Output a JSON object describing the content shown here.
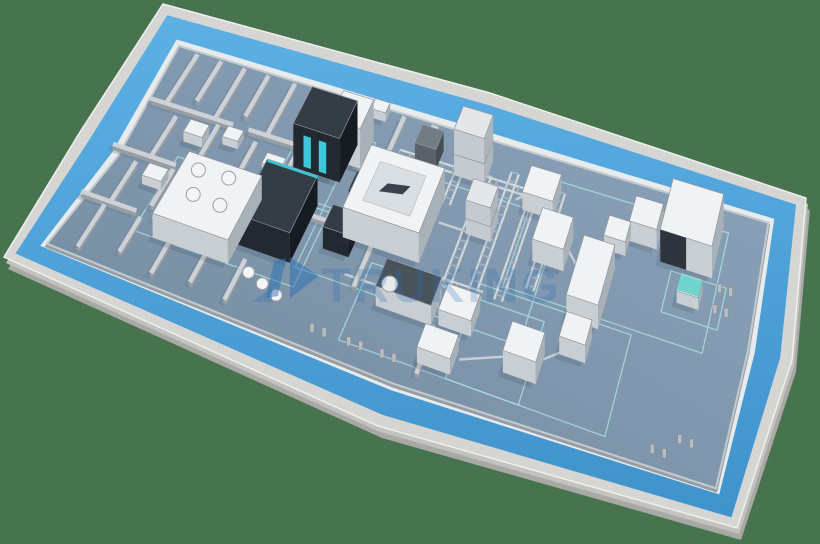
{
  "scene": {
    "canvas": {
      "w": 820,
      "h": 544
    },
    "palette": {
      "bg": "#48734f",
      "slab_side": "#a8a8a5",
      "slab_mid": "#c2c2bf",
      "rim": "#d5d5d3",
      "rim_edge": "#efefed",
      "walkway_light": "#5cb0e4",
      "walkway_dark": "#3f93cb",
      "wall_band": "#e8ebec",
      "inner_wall_edge": "#c3cacd",
      "floor_dark": "#72889c",
      "floor_light": "#8da5bd",
      "wall_top": "#cdd1d5",
      "wall_side": "#969da4",
      "wall_shadow": "#64798d",
      "marking": "#a9dcdd",
      "conv_rail": "#d2d8dc",
      "conv_rung": "#aeb6bd",
      "connector": "#c6ccd2",
      "mach_white_top": "#f0f2f3",
      "mach_white_l": "#c9ced3",
      "mach_white_r": "#a9b1b8",
      "mach_stroke": "#8f969c",
      "mach_dark_top": "#343c46",
      "mach_dark_l": "#232931",
      "mach_dark_r": "#171c22",
      "mach_gray_top": "#737b84",
      "mach_gray_l": "#5a6169",
      "mach_gray_r": "#474d54",
      "cyan": "#3fd9ec",
      "teal": "#5fd0c8",
      "htank_top": "#4a525a",
      "shadow": "#2c3e52",
      "tank_fill": "#f4f5f6",
      "tank_stroke": "#9aa1a8",
      "frame_post": "#b9bec2"
    },
    "outline": [
      [
        163,
        4
      ],
      [
        490,
        93
      ],
      [
        806,
        198
      ],
      [
        792,
        360
      ],
      [
        737,
        528
      ],
      [
        378,
        426
      ],
      [
        4,
        257
      ],
      [
        80,
        132
      ]
    ],
    "bands": {
      "rim": 12,
      "walkway": 26,
      "wall": 7
    },
    "watermark": {
      "text": "TRUKING",
      "color": "#2a6fb6",
      "text_opacity": 0.24,
      "logo_opacity": 0.5,
      "x": 322,
      "y": 302,
      "size": 48,
      "spacing": 3,
      "logo_paths": [
        {
          "d": "M266,298 L274,261 L286,258 L278,296 Z",
          "opacity": 0.5
        },
        {
          "d": "M290,257 L319,276 L290,298 Z",
          "opacity": 0.5
        },
        {
          "d": "M251,302 L272,288 L272,302 Z",
          "opacity": 0.3
        }
      ]
    },
    "walls": [
      [
        0.035,
        0.015,
        0.035,
        0.26
      ],
      [
        0.075,
        0.015,
        0.075,
        0.21
      ],
      [
        0.115,
        0.015,
        0.115,
        0.26
      ],
      [
        0.155,
        0.015,
        0.155,
        0.21
      ],
      [
        0.2,
        0.015,
        0.2,
        0.26
      ],
      [
        0.245,
        0.015,
        0.245,
        0.21
      ],
      [
        0.29,
        0.015,
        0.29,
        0.26
      ],
      [
        0.335,
        0.015,
        0.335,
        0.21
      ],
      [
        0.385,
        0.015,
        0.385,
        0.26
      ],
      [
        0.435,
        0.015,
        0.435,
        0.26
      ],
      [
        0.01,
        0.26,
        0.145,
        0.26
      ],
      [
        0.17,
        0.26,
        0.315,
        0.26
      ],
      [
        0.34,
        0.26,
        0.455,
        0.26
      ],
      [
        0.06,
        0.3,
        0.06,
        0.5
      ],
      [
        0.125,
        0.28,
        0.125,
        0.44
      ],
      [
        0.19,
        0.3,
        0.19,
        0.5
      ],
      [
        0.255,
        0.28,
        0.255,
        0.46
      ],
      [
        0.0,
        0.5,
        0.1,
        0.5
      ],
      [
        0.125,
        0.5,
        0.255,
        0.5
      ],
      [
        0.285,
        0.52,
        0.405,
        0.52
      ],
      [
        0.44,
        0.015,
        0.44,
        0.3
      ],
      [
        0.415,
        0.3,
        0.415,
        0.52
      ],
      [
        0.045,
        0.54,
        0.045,
        0.74
      ],
      [
        0.1,
        0.52,
        0.1,
        0.7
      ],
      [
        0.155,
        0.54,
        0.155,
        0.74
      ],
      [
        0.0,
        0.74,
        0.085,
        0.74
      ],
      [
        0.11,
        0.74,
        0.21,
        0.74
      ],
      [
        0.04,
        0.76,
        0.04,
        0.97
      ],
      [
        0.095,
        0.76,
        0.095,
        0.93
      ],
      [
        0.15,
        0.76,
        0.15,
        0.97
      ],
      [
        0.205,
        0.76,
        0.205,
        0.95
      ],
      [
        0.26,
        0.78,
        0.26,
        0.97
      ],
      [
        0.42,
        0.56,
        0.42,
        0.74
      ],
      [
        0.55,
        0.78,
        0.55,
        0.985
      ]
    ],
    "markings": [
      [
        0.245,
        0.15,
        0.115,
        0.33
      ],
      [
        0.095,
        0.46,
        0.245,
        0.36
      ],
      [
        0.33,
        0.22,
        0.345,
        0.52
      ],
      [
        0.43,
        0.62,
        0.27,
        0.34
      ],
      [
        0.625,
        0.08,
        0.315,
        0.46
      ],
      [
        0.59,
        0.56,
        0.24,
        0.4
      ],
      [
        0.865,
        0.28,
        0.09,
        0.16
      ]
    ],
    "ladders": [
      [
        0.545,
        0.14,
        0.545,
        0.6
      ],
      [
        0.585,
        0.1,
        0.585,
        0.58
      ],
      [
        0.625,
        0.16,
        0.625,
        0.6
      ],
      [
        0.665,
        0.12,
        0.665,
        0.52
      ],
      [
        0.5,
        0.03,
        0.5,
        0.3
      ]
    ],
    "long_rails": [
      [
        0.4,
        0.16,
        0.625,
        0.16
      ],
      [
        0.47,
        0.6,
        0.6,
        0.6
      ]
    ],
    "connectors": [
      [
        0.5,
        0.38,
        0.545,
        0.38
      ],
      [
        0.6,
        0.2,
        0.615,
        0.16
      ],
      [
        0.7,
        0.32,
        0.725,
        0.38
      ],
      [
        0.755,
        0.44,
        0.75,
        0.62
      ],
      [
        0.75,
        0.68,
        0.715,
        0.76
      ],
      [
        0.66,
        0.8,
        0.6,
        0.87
      ],
      [
        0.545,
        0.7,
        0.555,
        0.7
      ],
      [
        0.4,
        0.7,
        0.46,
        0.7
      ],
      [
        0.8,
        0.17,
        0.845,
        0.13
      ],
      [
        0.755,
        0.24,
        0.79,
        0.18
      ]
    ],
    "machines": [
      {
        "name": "tank-farm-unit",
        "u": 0.125,
        "v": 0.52,
        "du": 0.115,
        "dv": 0.3,
        "h": 24,
        "type": "tankfarm"
      },
      {
        "name": "dark-process-machine",
        "u": 0.24,
        "v": 0.47,
        "du": 0.08,
        "dv": 0.26,
        "h": 30,
        "type": "dark",
        "cyantop": true
      },
      {
        "name": "dark-tower-machine",
        "u": 0.26,
        "v": 0.18,
        "du": 0.075,
        "dv": 0.17,
        "h": 44,
        "type": "dark",
        "screens": true
      },
      {
        "name": "white-tower-machine",
        "u": 0.305,
        "v": 0.14,
        "du": 0.05,
        "dv": 0.13,
        "h": 40,
        "type": "white"
      },
      {
        "name": "filling-isolator",
        "u": 0.375,
        "v": 0.28,
        "du": 0.12,
        "dv": 0.28,
        "h": 30,
        "type": "white",
        "big": true
      },
      {
        "name": "gantry-tower",
        "u": 0.495,
        "v": 0.08,
        "du": 0.05,
        "dv": 0.1,
        "h": 46,
        "type": "truss"
      },
      {
        "name": "gantry-frame",
        "u": 0.545,
        "v": 0.3,
        "du": 0.04,
        "dv": 0.09,
        "h": 34,
        "type": "truss"
      },
      {
        "name": "gray-cube-unit",
        "u": 0.43,
        "v": 0.1,
        "du": 0.035,
        "dv": 0.08,
        "h": 20,
        "type": "gray"
      },
      {
        "name": "dark-cube-a",
        "u": 0.355,
        "v": 0.53,
        "du": 0.04,
        "dv": 0.1,
        "h": 22,
        "type": "dark"
      },
      {
        "name": "dark-cube-b",
        "u": 0.365,
        "v": 0.36,
        "du": 0.033,
        "dv": 0.08,
        "h": 20,
        "type": "dark"
      },
      {
        "name": "conveyor-station",
        "u": 0.615,
        "v": 0.12,
        "du": 0.05,
        "dv": 0.11,
        "h": 18,
        "type": "white"
      },
      {
        "name": "inspection-machine",
        "u": 0.655,
        "v": 0.28,
        "du": 0.05,
        "dv": 0.13,
        "h": 22,
        "type": "white"
      },
      {
        "name": "labelling-machine",
        "u": 0.73,
        "v": 0.34,
        "du": 0.05,
        "dv": 0.24,
        "h": 24,
        "type": "white"
      },
      {
        "name": "transfer-unit",
        "u": 0.735,
        "v": 0.62,
        "du": 0.04,
        "dv": 0.1,
        "h": 18,
        "type": "white"
      },
      {
        "name": "case-packer",
        "u": 0.665,
        "v": 0.74,
        "du": 0.05,
        "dv": 0.12,
        "h": 22,
        "type": "white"
      },
      {
        "name": "cartoning-machine",
        "u": 0.845,
        "v": 0.06,
        "du": 0.085,
        "dv": 0.2,
        "h": 32,
        "type": "white",
        "darkpanel": true
      },
      {
        "name": "buffer-station-a",
        "u": 0.79,
        "v": 0.12,
        "du": 0.045,
        "dv": 0.1,
        "h": 20,
        "type": "white"
      },
      {
        "name": "buffer-station-b",
        "u": 0.755,
        "v": 0.2,
        "du": 0.035,
        "dv": 0.08,
        "h": 14,
        "type": "white"
      },
      {
        "name": "agv-robot",
        "u": 0.885,
        "v": 0.32,
        "du": 0.035,
        "dv": 0.07,
        "h": 12,
        "type": "teal"
      },
      {
        "name": "sterilizer-tank",
        "u": 0.46,
        "v": 0.66,
        "du": 0.085,
        "dv": 0.12,
        "h": 20,
        "type": "htank"
      },
      {
        "name": "washing-machine",
        "u": 0.555,
        "v": 0.66,
        "du": 0.05,
        "dv": 0.11,
        "h": 16,
        "type": "white"
      },
      {
        "name": "bottom-line-unit",
        "u": 0.545,
        "v": 0.84,
        "du": 0.05,
        "dv": 0.1,
        "h": 16,
        "type": "white"
      },
      {
        "name": "room-cart-a",
        "u": 0.09,
        "v": 0.33,
        "du": 0.03,
        "dv": 0.06,
        "h": 10,
        "type": "white"
      },
      {
        "name": "room-cart-b",
        "u": 0.145,
        "v": 0.3,
        "du": 0.025,
        "dv": 0.05,
        "h": 8,
        "type": "white"
      },
      {
        "name": "room-cart-c",
        "u": 0.22,
        "v": 0.36,
        "du": 0.03,
        "dv": 0.05,
        "h": 9,
        "type": "white"
      },
      {
        "name": "room-cart-d",
        "u": 0.07,
        "v": 0.56,
        "du": 0.03,
        "dv": 0.06,
        "h": 9,
        "type": "white"
      },
      {
        "name": "room-cart-e",
        "u": 0.3,
        "v": 0.3,
        "du": 0.025,
        "dv": 0.05,
        "h": 8,
        "type": "white"
      },
      {
        "name": "top-wall-door",
        "u": 0.335,
        "v": 0.01,
        "du": 0.025,
        "dv": 0.045,
        "h": 9,
        "type": "white"
      }
    ],
    "tanks": [
      [
        0.275,
        0.84
      ],
      [
        0.3,
        0.865
      ],
      [
        0.325,
        0.89
      ]
    ],
    "door_frames": [
      [
        0.4,
        0.965
      ],
      [
        0.455,
        0.965
      ],
      [
        0.505,
        0.965
      ],
      [
        0.91,
        0.955
      ],
      [
        0.945,
        0.885
      ],
      [
        0.955,
        0.3
      ],
      [
        0.955,
        0.38
      ]
    ]
  }
}
